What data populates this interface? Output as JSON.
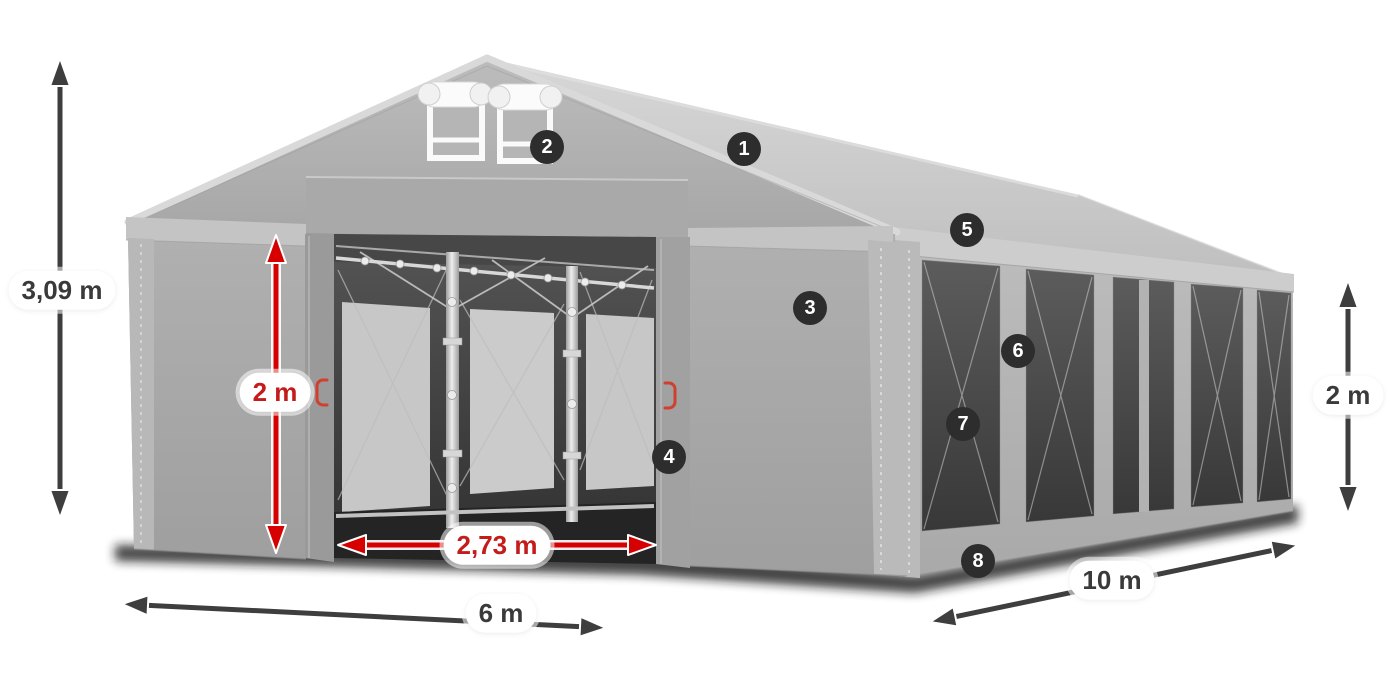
{
  "dimensions": {
    "total_height": "3,09 m",
    "door_height": "2 m",
    "door_width": "2,73 m",
    "front_width": "6 m",
    "side_length": "10 m",
    "wall_height": "2 m"
  },
  "markers": [
    {
      "number": "1"
    },
    {
      "number": "2"
    },
    {
      "number": "3"
    },
    {
      "number": "4"
    },
    {
      "number": "5"
    },
    {
      "number": "6"
    },
    {
      "number": "7"
    },
    {
      "number": "8"
    }
  ],
  "colors": {
    "accent_red": "#d60000",
    "red_text": "#c41b1b",
    "arrow_dark": "#3e3e3e",
    "label_text": "#3a3a3a",
    "badge_bg": "#2d2d2d",
    "badge_text": "#ffffff",
    "background": "#ffffff"
  }
}
